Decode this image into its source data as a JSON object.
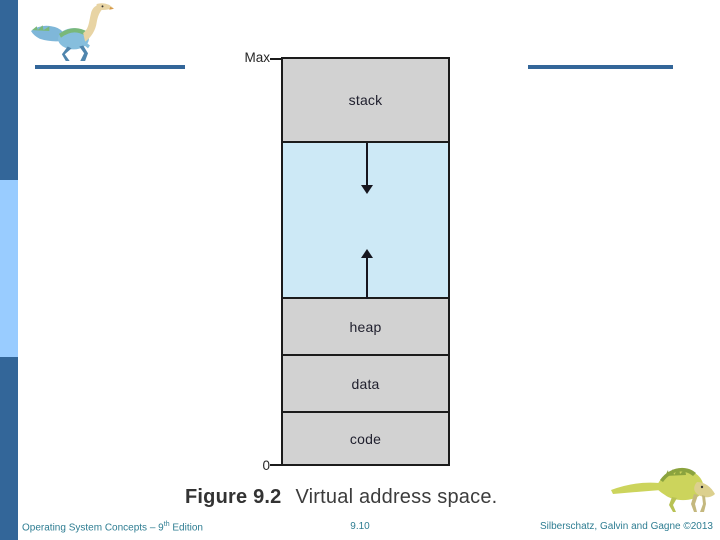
{
  "slide": {
    "diagram": {
      "max_label": "Max",
      "zero_label": "0",
      "stack_label": "stack",
      "heap_label": "heap",
      "data_label": "data",
      "code_label": "code"
    },
    "caption": {
      "figure_number": "Figure 9.2",
      "figure_title": "Virtual address space."
    },
    "footer": {
      "book": "Operating System Concepts – 9",
      "edition_sup": "th",
      "edition_rest": " Edition",
      "page": "9.10",
      "authors": "Silberschatz, Galvin and Gagne ©2013"
    },
    "icons": {
      "top_left": "dinosaur-icon",
      "bottom_right": "dinosaur-icon"
    },
    "colors": {
      "accent_dark_blue": "#336699",
      "accent_light_blue": "#99ccff",
      "footer_text": "#2e7d92",
      "diagram_gray": "#d2d2d2",
      "diagram_free_space_blue": "#cde9f6",
      "diagram_border": "#1b1b1b"
    }
  }
}
